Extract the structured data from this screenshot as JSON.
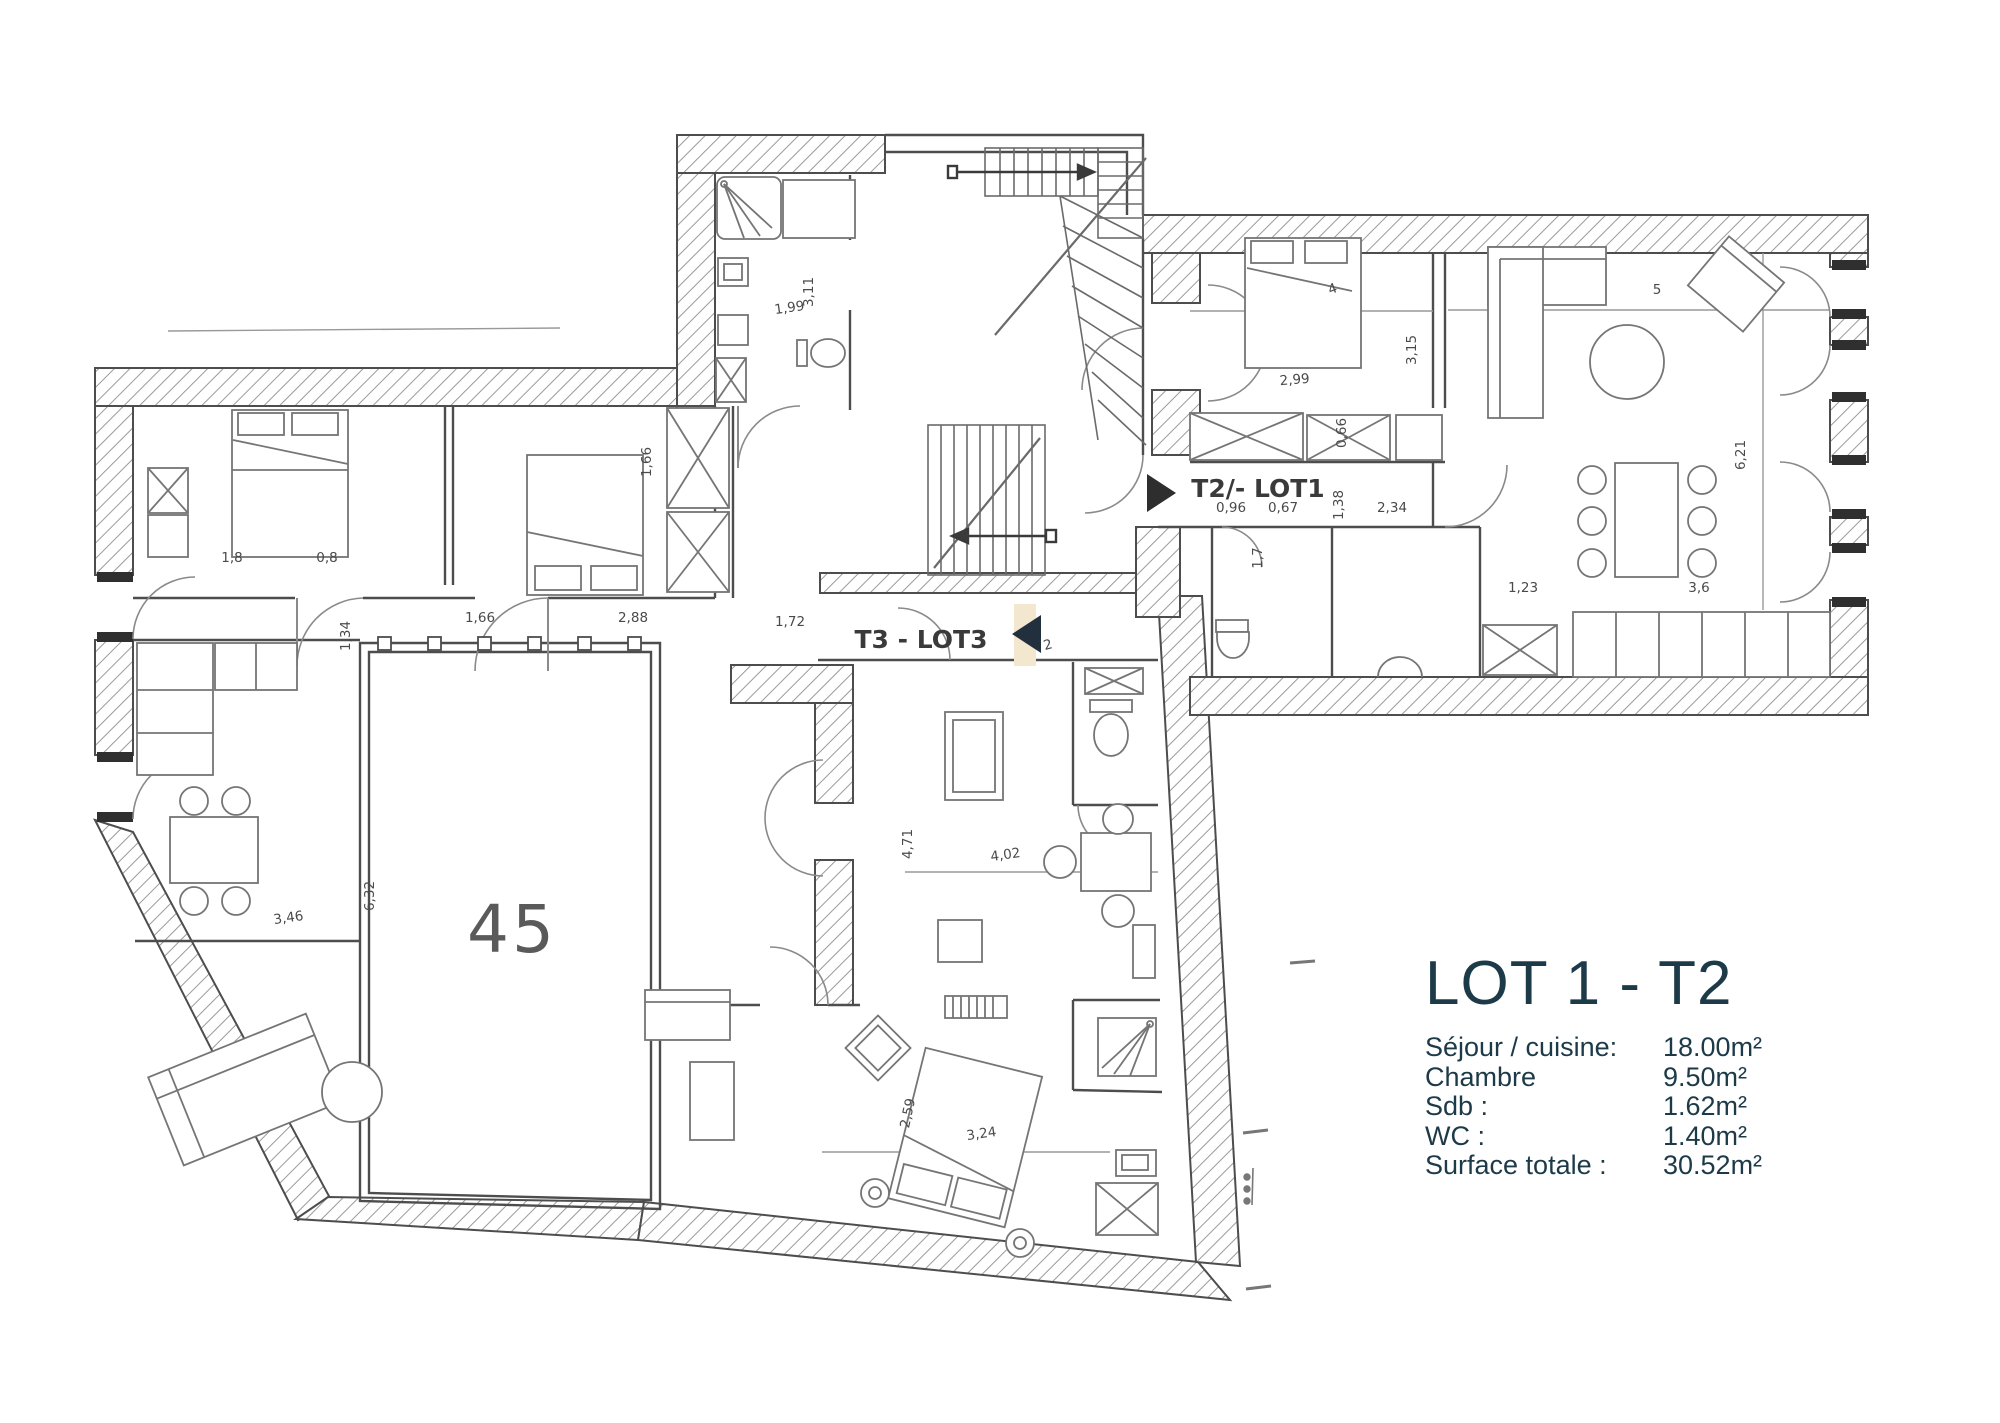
{
  "legend": {
    "title": "LOT 1 - T2",
    "items": [
      {
        "label": "Séjour / cuisine:",
        "value": "18.00m²"
      },
      {
        "label": "Chambre",
        "value": "9.50m²"
      },
      {
        "label": "Sdb :",
        "value": "1.62m²"
      },
      {
        "label": "WC :",
        "value": "1.40m²"
      },
      {
        "label": "Surface totale :",
        "value": "30.52m²"
      }
    ]
  },
  "plan": {
    "unit_labels": [
      {
        "id": "unit-label-t2-lot1",
        "text": "T2/- LOT1",
        "x": 1258,
        "y": 497,
        "size": 25,
        "weight": "bold",
        "rot": 0
      },
      {
        "id": "unit-label-t3-lot3",
        "text": "T3 - LOT3",
        "x": 921,
        "y": 648,
        "size": 25,
        "weight": "bold",
        "rot": 0
      },
      {
        "id": "room-number-45",
        "text": "45",
        "x": 512,
        "y": 952,
        "size": 66,
        "weight": "normal",
        "rot": 0
      }
    ],
    "dimensions": [
      {
        "text": "1,99",
        "x": 790,
        "y": 312,
        "rot": -8
      },
      {
        "text": "3,11",
        "x": 813,
        "y": 292,
        "rot": -90
      },
      {
        "text": "2,99",
        "x": 1295,
        "y": 384,
        "rot": -5
      },
      {
        "text": "3,15",
        "x": 1416,
        "y": 350,
        "rot": -90
      },
      {
        "text": "4",
        "x": 1334,
        "y": 293,
        "rot": -20
      },
      {
        "text": "5",
        "x": 1657,
        "y": 294,
        "rot": 0
      },
      {
        "text": "6,21",
        "x": 1745,
        "y": 455,
        "rot": -90
      },
      {
        "text": "1,23",
        "x": 1523,
        "y": 592,
        "rot": 0
      },
      {
        "text": "3,6",
        "x": 1699,
        "y": 592,
        "rot": 0
      },
      {
        "text": "0,96",
        "x": 1231,
        "y": 512,
        "rot": 0
      },
      {
        "text": "0,67",
        "x": 1283,
        "y": 512,
        "rot": 0
      },
      {
        "text": "1,38",
        "x": 1343,
        "y": 505,
        "rot": -90
      },
      {
        "text": "2,34",
        "x": 1392,
        "y": 512,
        "rot": 0
      },
      {
        "text": "0,66",
        "x": 1346,
        "y": 433,
        "rot": -90
      },
      {
        "text": "1,7",
        "x": 1262,
        "y": 558,
        "rot": -90
      },
      {
        "text": "1,8",
        "x": 232,
        "y": 562,
        "rot": 0
      },
      {
        "text": "0,8",
        "x": 327,
        "y": 562,
        "rot": 0
      },
      {
        "text": "1,66",
        "x": 480,
        "y": 622,
        "rot": 0
      },
      {
        "text": "2,88",
        "x": 633,
        "y": 622,
        "rot": 0
      },
      {
        "text": "1,72",
        "x": 790,
        "y": 626,
        "rot": 0
      },
      {
        "text": "1,66",
        "x": 651,
        "y": 462,
        "rot": -90
      },
      {
        "text": "1,34",
        "x": 350,
        "y": 636,
        "rot": -90
      },
      {
        "text": "6,32",
        "x": 374,
        "y": 896,
        "rot": -90
      },
      {
        "text": "3,46",
        "x": 289,
        "y": 922,
        "rot": -8
      },
      {
        "text": "4,71",
        "x": 912,
        "y": 844,
        "rot": -90
      },
      {
        "text": "4,02",
        "x": 1006,
        "y": 859,
        "rot": -8
      },
      {
        "text": "3,24",
        "x": 982,
        "y": 1138,
        "rot": -8
      },
      {
        "text": "2,59",
        "x": 912,
        "y": 1114,
        "rot": -78
      },
      {
        "text": "2",
        "x": 1049,
        "y": 649,
        "rot": -15
      }
    ]
  },
  "colors": {
    "legend_text": "#1c3a48",
    "ink": "#4d4d4d",
    "dim_text": "#4a4a4a",
    "arrow": "#2e2e2e",
    "cream": "#f3e8cf"
  }
}
